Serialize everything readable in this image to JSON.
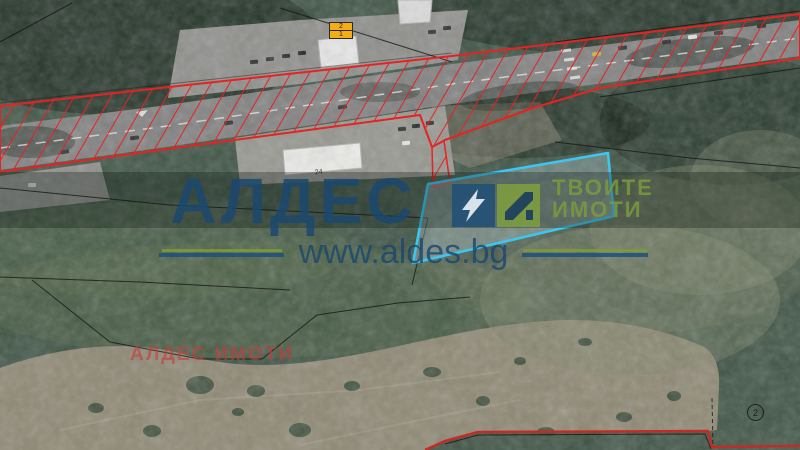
{
  "watermark": {
    "brand": "АЛДЕС",
    "tagline_line1": "ТВОИТЕ",
    "tagline_line2": "ИМОТИ",
    "url": "www.aldes.bg",
    "agency_label": "АЛДЕС ИМОТИ",
    "brand_color": "#1d4a73",
    "tagline_color": "#7da23c",
    "agency_color": "#c63c3c"
  },
  "map_overlays": {
    "parcel": {
      "points": "428,184 608,153 614,216 413,263",
      "stroke_color": "#3ac8f2"
    },
    "corridor": {
      "points": "0,106 160,88 452,56 800,14 800,58 600,88 533,108 445,140 432,147 420,115 160,150 0,172",
      "hatch_color": "#e62222"
    },
    "corridor_wedge": {
      "points": "432,147 444,141 450,183 433,187"
    },
    "south_boundary": {
      "points": "425,450 445,441 478,432 708,431 712,447 800,446",
      "color": "#c32b25"
    },
    "labels": {
      "sign_top": "2",
      "sign_bottom": "1",
      "building_number": "24",
      "parcel_circle": "2"
    }
  }
}
